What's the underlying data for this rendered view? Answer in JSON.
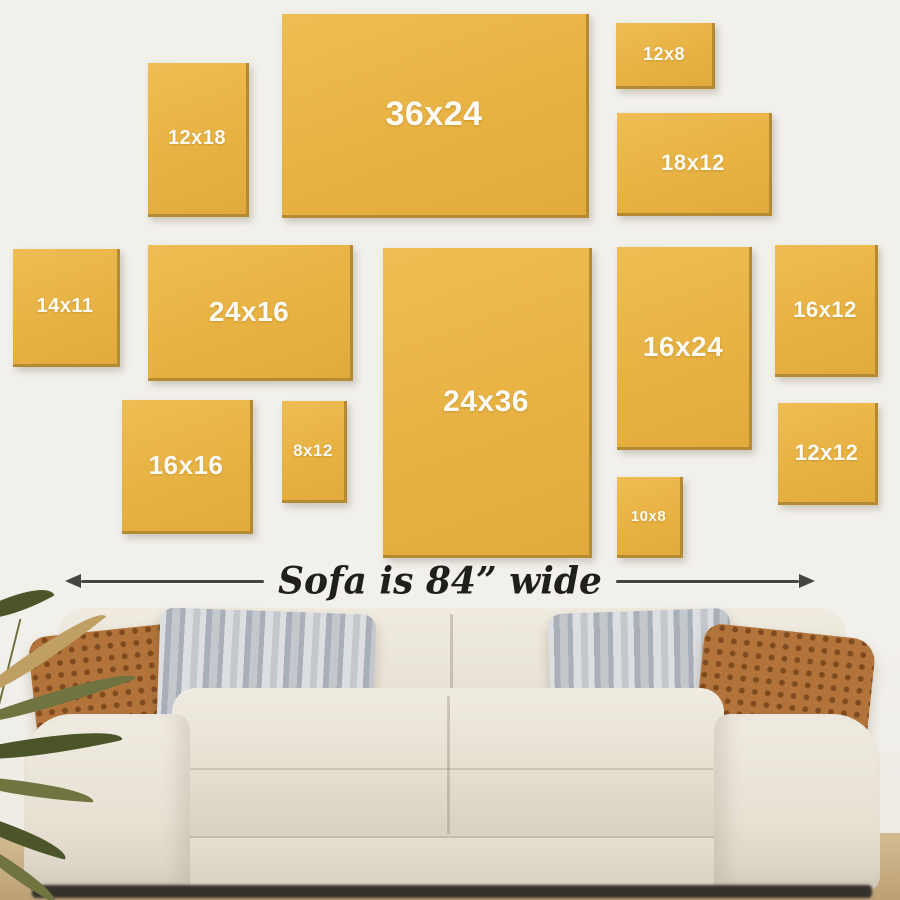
{
  "title": "Wall art size guide above sofa",
  "caption": {
    "text": "Sofa is 84” wide"
  },
  "frames": [
    {
      "label": "12x18",
      "x": 148,
      "y": 63,
      "w": 101,
      "h": 154,
      "fs": 20
    },
    {
      "label": "36x24",
      "x": 282,
      "y": 14,
      "w": 307,
      "h": 204,
      "fs": 34
    },
    {
      "label": "12x8",
      "x": 616,
      "y": 23,
      "w": 99,
      "h": 66,
      "fs": 18
    },
    {
      "label": "18x12",
      "x": 617,
      "y": 113,
      "w": 155,
      "h": 103,
      "fs": 22
    },
    {
      "label": "14x11",
      "x": 13,
      "y": 249,
      "w": 107,
      "h": 118,
      "fs": 20
    },
    {
      "label": "24x16",
      "x": 148,
      "y": 245,
      "w": 205,
      "h": 136,
      "fs": 28
    },
    {
      "label": "24x36",
      "x": 383,
      "y": 248,
      "w": 209,
      "h": 310,
      "fs": 30
    },
    {
      "label": "16x24",
      "x": 617,
      "y": 247,
      "w": 135,
      "h": 203,
      "fs": 28
    },
    {
      "label": "16x12",
      "x": 775,
      "y": 245,
      "w": 103,
      "h": 132,
      "fs": 22
    },
    {
      "label": "16x16",
      "x": 122,
      "y": 400,
      "w": 131,
      "h": 134,
      "fs": 26
    },
    {
      "label": "8x12",
      "x": 282,
      "y": 401,
      "w": 65,
      "h": 102,
      "fs": 17
    },
    {
      "label": "10x8",
      "x": 617,
      "y": 477,
      "w": 66,
      "h": 81,
      "fs": 15
    },
    {
      "label": "12x12",
      "x": 778,
      "y": 403,
      "w": 100,
      "h": 102,
      "fs": 22
    }
  ],
  "colors": {
    "wall": "#f2f0eb",
    "wall_bottom": "#edeae3",
    "frame_gold": "#e8b243",
    "frame_gold_hi": "#eebd53",
    "frame_gold_lo": "#e2aa3b",
    "frame_gold_edge": "#b48b32",
    "frame_label": "#fdfbf6",
    "caption_text": "#211f1c",
    "arrow": "#45443f",
    "sofa_light": "#f0ebe1",
    "sofa_mid": "#e7e1d4",
    "sofa_dark": "#d8d1c1",
    "pillow_rust": "#b3743c",
    "pillow_rust_dark": "#7e4a1e",
    "pillow_gray_light": "#dcdee1",
    "pillow_gray_mid": "#c4c8cd",
    "pillow_gray_dark": "#a9afb9",
    "plant_dark": "#4c5429",
    "plant_mid": "#707440",
    "plant_tan": "#bf9f63",
    "floor_tan": "#d3bc93",
    "floor_edge": "#bda075",
    "under_shadow": "#35312b"
  }
}
